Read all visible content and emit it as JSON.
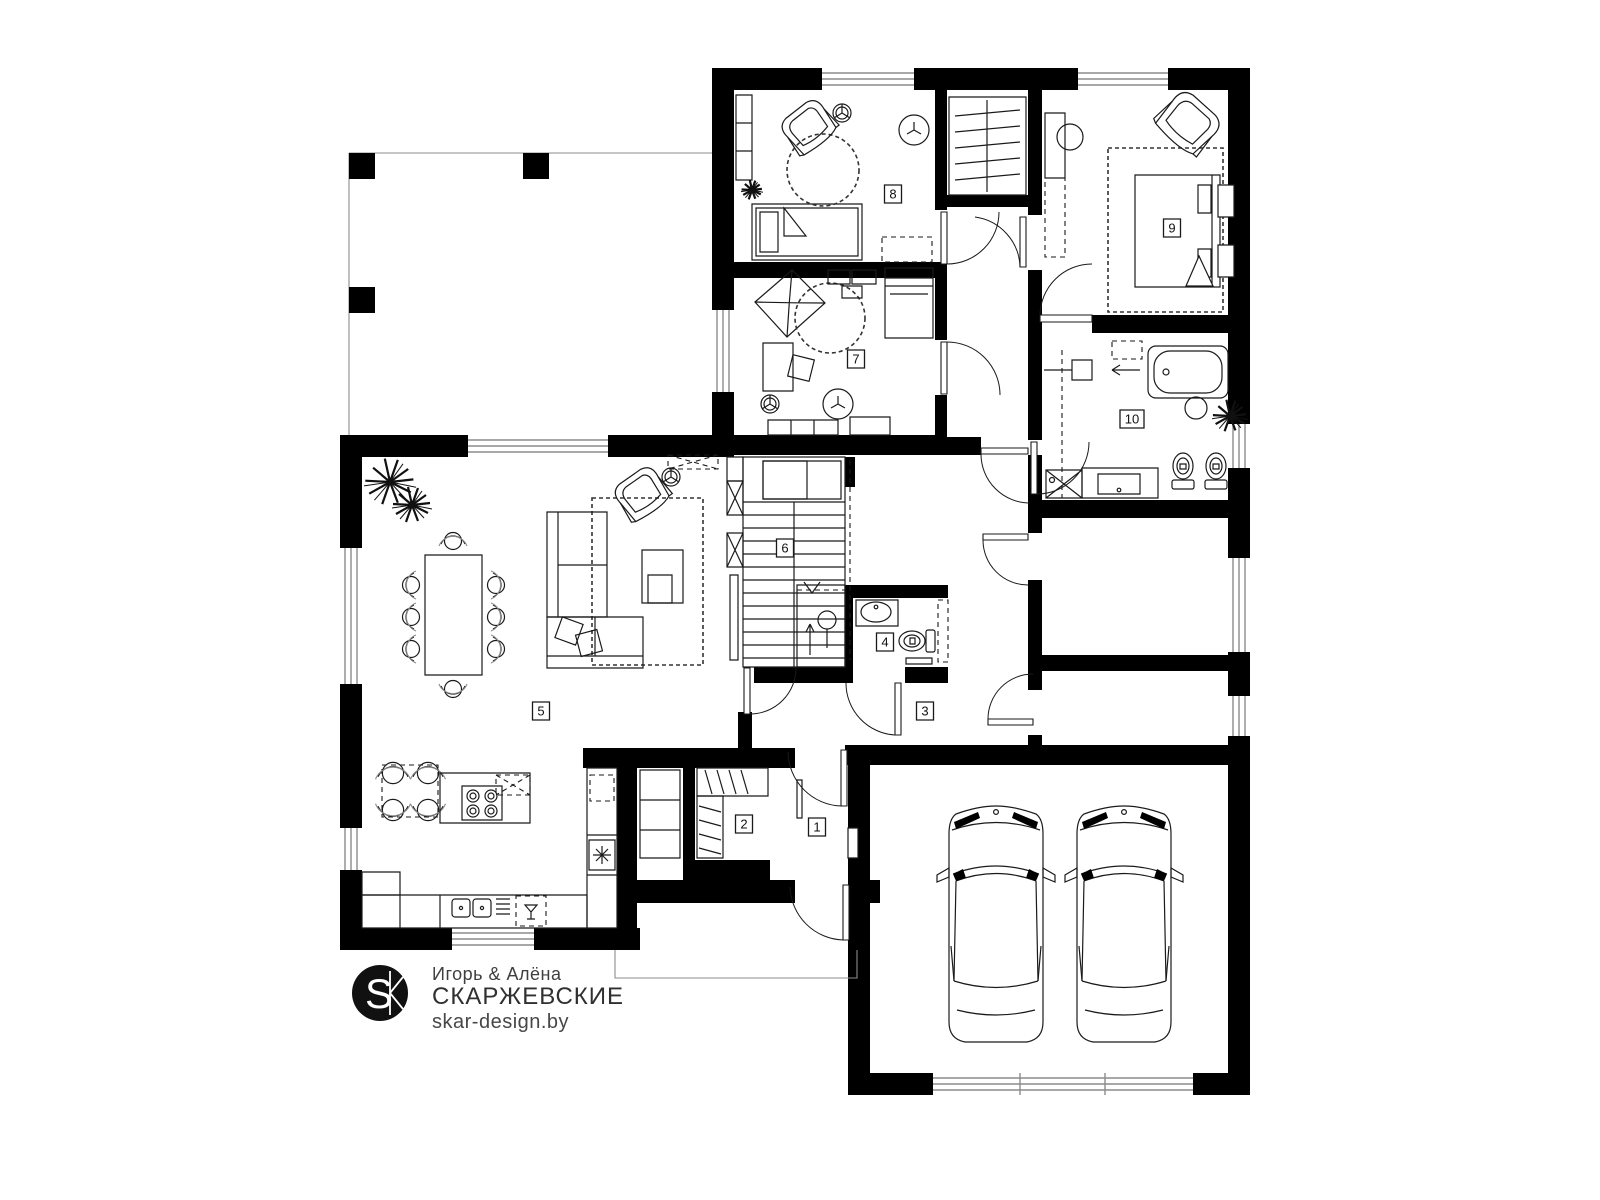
{
  "colors": {
    "wall": "#000000",
    "line": "#1a1a1a",
    "soft_gray": "#8c8c8c",
    "background": "#ffffff"
  },
  "logo": {
    "monogram": "SK",
    "line1": "Игорь & Алёна",
    "line2": "СКАРЖЕВСКИЕ",
    "line3": "skar-design.by"
  },
  "plan": {
    "room_labels": [
      {
        "num": "1",
        "x": 817,
        "y": 827
      },
      {
        "num": "2",
        "x": 744,
        "y": 824
      },
      {
        "num": "3",
        "x": 925,
        "y": 711
      },
      {
        "num": "4",
        "x": 885,
        "y": 642
      },
      {
        "num": "5",
        "x": 541,
        "y": 711
      },
      {
        "num": "6",
        "x": 785,
        "y": 548
      },
      {
        "num": "7",
        "x": 856,
        "y": 359
      },
      {
        "num": "8",
        "x": 893,
        "y": 194
      },
      {
        "num": "9",
        "x": 1172,
        "y": 228
      },
      {
        "num": "10",
        "x": 1132,
        "y": 419
      }
    ]
  }
}
